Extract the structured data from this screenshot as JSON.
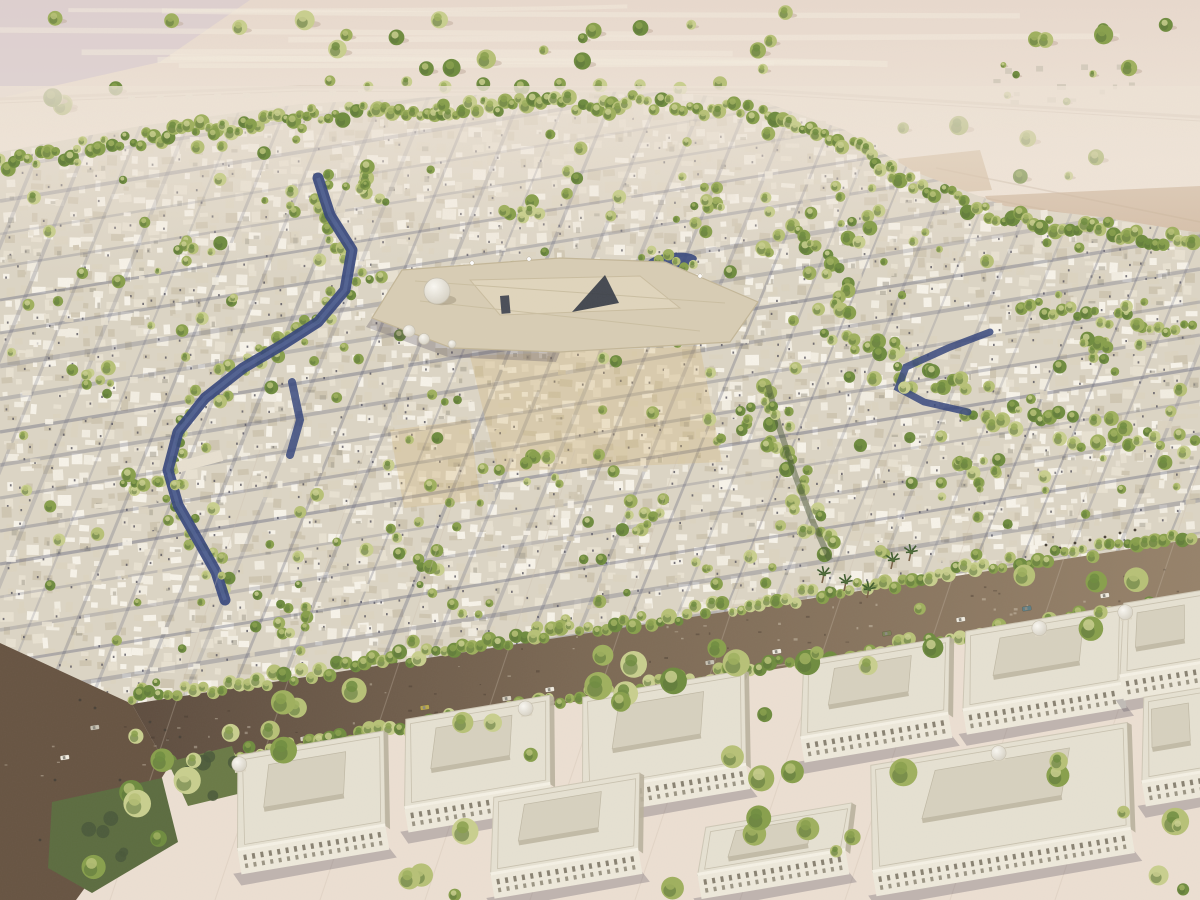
{
  "meta": {
    "description": "Aerial watercolor-style architectural rendering of a desert city master plan: dense low-rise white courtyard housing with tree-lined streets, a central domed mosque-palace complex, winding green water corridors, a diagonal brown boulevard with cars, and rows of formal classical buildings in the foreground; open desert with scattered trees beyond the city edge."
  },
  "palette": {
    "desert_top": "#e8d9cd",
    "desert_mid": "#f0e5d8",
    "desert_low": "#ecdfd2",
    "desert_purple": "#d5c9d2",
    "sand_streak": "#f4ebde",
    "city_base": "#dcd5c5",
    "bld": [
      "#f2ede1",
      "#e8e1d1",
      "#dcd4c1",
      "#cfc6b1",
      "#f7f3e9"
    ],
    "bld_gap": "#a9a494",
    "win": "#55525c",
    "street": "#5d6078",
    "street_lt": "#8c8fa6",
    "tree": [
      "#b7c177",
      "#9fb05e",
      "#88a04c",
      "#6f8c3f",
      "#c9cf8e"
    ],
    "tree_dark": "#5a7338",
    "tree_deep": "#49583a",
    "water": "#36477c",
    "water_lt": "#5d6f9e",
    "road_dark": "#5e4d3f",
    "road_mid": "#7d6a55",
    "road_lt": "#96826a",
    "junction": "#675442",
    "park": "#5c6c40",
    "park2": "#6a7a46",
    "formal_wall": "#eee9db",
    "formal_roof": "#e6e1d2",
    "formal_roof2": "#d7d1bf",
    "formal_shadow": "#b9b19d",
    "formal_win": "#77705f",
    "landmark": "#d8cdb4",
    "landmark_in": "#e0d5bc",
    "landmark_dark": "#343a45",
    "dome_hi": "#faf8f2",
    "dome_lo": "#cdc7b8",
    "grid_line": "#cdbfae",
    "track": "#d2c2b2",
    "shadow_soft": "rgba(75,70,85,0.28)",
    "tint_souq": "rgba(212,182,120,0.30)"
  },
  "scene": {
    "canvas": {
      "width": 1200,
      "height": 900
    },
    "seed": 1973,
    "desert": {
      "tree_count": 38,
      "road": [
        [
          0,
          99
        ],
        [
          300,
          87
        ],
        [
          760,
          90
        ],
        [
          1200,
          117
        ]
      ],
      "road_tree_row": [
        [
          330,
          84
        ],
        [
          560,
          84
        ],
        [
          760,
          86
        ]
      ],
      "tracks": [
        [
          [
            882,
            196
          ],
          [
            1200,
            262
          ]
        ],
        [
          [
            903,
            182
          ],
          [
            1200,
            240
          ]
        ],
        [
          [
            936,
            168
          ],
          [
            1200,
            222
          ]
        ]
      ],
      "settlement_right": {
        "x": 992,
        "y": 62,
        "w": 150,
        "h": 40,
        "count": 13
      },
      "wall_left": {
        "x1": 128,
        "y1": 96,
        "x2": 358,
        "y2": 90,
        "count": 9
      },
      "fields": [
        [
          [
            985,
            196
          ],
          [
            1200,
            186
          ],
          [
            1200,
            254
          ],
          [
            1012,
            240
          ]
        ],
        [
          [
            868,
            162
          ],
          [
            980,
            150
          ],
          [
            992,
            190
          ],
          [
            880,
            198
          ]
        ]
      ],
      "purple_patch": [
        [
          0,
          0
        ],
        [
          250,
          0
        ],
        [
          160,
          62
        ],
        [
          0,
          98
        ]
      ]
    },
    "city_boundary": [
      [
        0,
        152
      ],
      [
        140,
        126
      ],
      [
        300,
        104
      ],
      [
        470,
        95
      ],
      [
        640,
        91
      ],
      [
        755,
        99
      ],
      [
        845,
        130
      ],
      [
        915,
        172
      ],
      [
        1005,
        206
      ],
      [
        1100,
        217
      ],
      [
        1200,
        233
      ]
    ],
    "city_poly": [
      [
        0,
        152
      ],
      [
        140,
        126
      ],
      [
        300,
        104
      ],
      [
        470,
        95
      ],
      [
        640,
        91
      ],
      [
        755,
        99
      ],
      [
        845,
        130
      ],
      [
        915,
        172
      ],
      [
        1005,
        206
      ],
      [
        1100,
        217
      ],
      [
        1200,
        233
      ],
      [
        1200,
        540
      ],
      [
        135,
        707
      ],
      [
        0,
        648
      ]
    ],
    "fabric": {
      "step": 13,
      "skip": 0.16,
      "window_prob": 0.34
    },
    "streets": {
      "shallow": {
        "y_start": 135,
        "y_end": 860,
        "spacing": 33,
        "drop": 196
      },
      "steep": {
        "x_start": 70,
        "x_end": 1560,
        "spacing": 46,
        "shift": 300,
        "y_top": 74,
        "y_bot": 810
      }
    },
    "souq_tints": [
      [
        [
          470,
          356
        ],
        [
          700,
          346
        ],
        [
          722,
          462
        ],
        [
          498,
          472
        ]
      ],
      [
        [
          390,
          430
        ],
        [
          470,
          420
        ],
        [
          480,
          500
        ],
        [
          404,
          508
        ]
      ]
    ],
    "water": {
      "left_channel": [
        [
          318,
          178
        ],
        [
          330,
          215
        ],
        [
          352,
          250
        ],
        [
          345,
          290
        ],
        [
          318,
          322
        ],
        [
          282,
          345
        ],
        [
          243,
          368
        ],
        [
          205,
          398
        ],
        [
          178,
          432
        ],
        [
          168,
          470
        ],
        [
          178,
          505
        ],
        [
          198,
          540
        ],
        [
          216,
          572
        ],
        [
          225,
          600
        ]
      ],
      "left_arm": [
        [
          292,
          382
        ],
        [
          300,
          420
        ],
        [
          290,
          455
        ]
      ],
      "bridge": {
        "x": 176,
        "y": 462,
        "w": 46,
        "h": 11,
        "rot": -15
      },
      "pond": {
        "cx": 672,
        "cy": 261,
        "rx": 25,
        "ry": 8,
        "rot": -6
      },
      "stream_right": [
        [
          990,
          332
        ],
        [
          948,
          348
        ],
        [
          906,
          367
        ],
        [
          898,
          388
        ],
        [
          924,
          402
        ],
        [
          968,
          412
        ]
      ]
    },
    "green": {
      "top_belt_offset": 12,
      "corridor_right": [
        [
          772,
          232
        ],
        [
          838,
          268
        ],
        [
          833,
          318
        ],
        [
          870,
          356
        ],
        [
          928,
          388
        ],
        [
          1005,
          410
        ],
        [
          1085,
          430
        ],
        [
          1160,
          447
        ],
        [
          1200,
          456
        ]
      ],
      "corridor_center": [
        [
          768,
          385
        ],
        [
          780,
          430
        ],
        [
          795,
          475
        ],
        [
          812,
          520
        ],
        [
          830,
          560
        ]
      ],
      "small_belt_right": [
        [
          1022,
          306
        ],
        [
          1110,
          318
        ],
        [
          1200,
          331
        ]
      ],
      "cluster_centers": [
        [
          360,
          180
        ],
        [
          200,
          250
        ],
        [
          520,
          210
        ],
        [
          700,
          200
        ],
        [
          860,
          230
        ],
        [
          150,
          480
        ],
        [
          420,
          560
        ],
        [
          640,
          520
        ],
        [
          980,
          470
        ],
        [
          1100,
          350
        ],
        [
          760,
          420
        ],
        [
          300,
          620
        ],
        [
          90,
          380
        ],
        [
          540,
          470
        ]
      ],
      "scatter_count": 290,
      "bottom_scatter_count": 130,
      "palms": [
        [
          824,
          574
        ],
        [
          846,
          582
        ],
        [
          869,
          589
        ],
        [
          893,
          560
        ],
        [
          911,
          552
        ]
      ]
    },
    "landmark": {
      "platform": [
        [
          372,
          318
        ],
        [
          402,
          270
        ],
        [
          560,
          258
        ],
        [
          665,
          262
        ],
        [
          758,
          302
        ],
        [
          730,
          342
        ],
        [
          560,
          352
        ],
        [
          452,
          348
        ]
      ],
      "court": [
        [
          470,
          280
        ],
        [
          640,
          276
        ],
        [
          680,
          308
        ],
        [
          500,
          315
        ]
      ],
      "south_shade": [
        [
          372,
          318
        ],
        [
          452,
          348
        ],
        [
          560,
          352
        ],
        [
          556,
          362
        ],
        [
          448,
          357
        ],
        [
          366,
          327
        ]
      ],
      "dome_main": {
        "cx": 437,
        "cy": 291,
        "r": 13
      },
      "domes_small": [
        [
          409,
          331,
          6
        ],
        [
          424,
          339,
          5.5
        ],
        [
          452,
          344,
          4
        ]
      ],
      "dark_wedge": [
        [
          572,
          312
        ],
        [
          605,
          275
        ],
        [
          619,
          303
        ]
      ],
      "gate": {
        "x": 500,
        "y": 296,
        "w": 9,
        "h": 18
      },
      "minarets": [
        [
          472,
          263
        ],
        [
          529,
          259
        ],
        [
          700,
          276
        ]
      ]
    },
    "boulevard": {
      "band": [
        [
          132,
          704
        ],
        [
          1200,
          538
        ],
        [
          1200,
          600
        ],
        [
          168,
          768
        ]
      ],
      "junction": [
        [
          0,
          643
        ],
        [
          132,
          704
        ],
        [
          168,
          768
        ],
        [
          140,
          812
        ],
        [
          76,
          900
        ],
        [
          0,
          900
        ]
      ],
      "top_edge": [
        [
          132,
          700
        ],
        [
          660,
          618
        ],
        [
          1200,
          534
        ]
      ],
      "bottom_edge": [
        [
          170,
          766
        ],
        [
          700,
          678
        ],
        [
          1200,
          599
        ]
      ],
      "grid_lines": {
        "count": 10,
        "x0": 260,
        "spacing": 105,
        "shift": 150
      },
      "cars": [
        {
          "x": 545,
          "y": 688,
          "c": "#f1ece0"
        },
        {
          "x": 300,
          "y": 737,
          "c": "#d9d2c2"
        },
        {
          "x": 215,
          "y": 752,
          "c": "#f1ece0"
        },
        {
          "x": 420,
          "y": 706,
          "c": "#b9a84b"
        },
        {
          "x": 632,
          "y": 673,
          "c": "#f1ece0"
        },
        {
          "x": 705,
          "y": 661,
          "c": "#c8c2b2"
        },
        {
          "x": 772,
          "y": 650,
          "c": "#f1ece0"
        },
        {
          "x": 882,
          "y": 632,
          "c": "#7b8556"
        },
        {
          "x": 956,
          "y": 618,
          "c": "#f1ece0"
        },
        {
          "x": 1022,
          "y": 607,
          "c": "#5e7f86"
        },
        {
          "x": 1100,
          "y": 594,
          "c": "#f1ece0"
        },
        {
          "x": 90,
          "y": 726,
          "c": "#c8c2b2"
        },
        {
          "x": 60,
          "y": 756,
          "c": "#f1ece0"
        },
        {
          "x": 502,
          "y": 697,
          "c": "#d9d2c2"
        }
      ],
      "people": [
        [
          1046,
          545
        ],
        [
          1060,
          548
        ],
        [
          1075,
          543
        ],
        [
          1090,
          540
        ],
        [
          1105,
          537
        ],
        [
          1120,
          533
        ],
        [
          1135,
          530
        ],
        [
          150,
          722
        ],
        [
          165,
          730
        ],
        [
          180,
          737
        ],
        [
          80,
          700
        ],
        [
          95,
          708
        ],
        [
          55,
          780
        ],
        [
          85,
          800
        ],
        [
          120,
          780
        ],
        [
          40,
          840
        ],
        [
          70,
          845
        ],
        [
          155,
          795
        ]
      ]
    },
    "parks": [
      [
        [
          52,
          802
        ],
        [
          162,
          778
        ],
        [
          178,
          842
        ],
        [
          92,
          893
        ],
        [
          48,
          868
        ]
      ],
      [
        [
          168,
          762
        ],
        [
          232,
          746
        ],
        [
          246,
          792
        ],
        [
          188,
          806
        ]
      ]
    ],
    "formal_buildings": [
      {
        "x": 222,
        "y": 758,
        "w": 150,
        "h": 118,
        "dome": "tl"
      },
      {
        "x": 390,
        "y": 722,
        "w": 148,
        "h": 112,
        "dome": "tr"
      },
      {
        "x": 567,
        "y": 700,
        "w": 166,
        "h": 118,
        "dome": null
      },
      {
        "x": 788,
        "y": 664,
        "w": 150,
        "h": 100,
        "dome": null
      },
      {
        "x": 950,
        "y": 634,
        "w": 162,
        "h": 102,
        "dome": "tc"
      },
      {
        "x": 1108,
        "y": 606,
        "w": 92,
        "h": 96,
        "dome": "tl"
      },
      {
        "x": 478,
        "y": 800,
        "w": 150,
        "h": 100,
        "dome": null
      },
      {
        "x": 690,
        "y": 830,
        "w": 150,
        "h": 70,
        "dome": null
      },
      {
        "x": 855,
        "y": 768,
        "w": 262,
        "h": 130,
        "dome": "tc"
      },
      {
        "x": 1128,
        "y": 700,
        "w": 72,
        "h": 108,
        "dome": null
      }
    ],
    "bottom_band": [
      [
        140,
        712
      ],
      [
        1200,
        545
      ],
      [
        1200,
        900
      ],
      [
        60,
        900
      ]
    ]
  }
}
